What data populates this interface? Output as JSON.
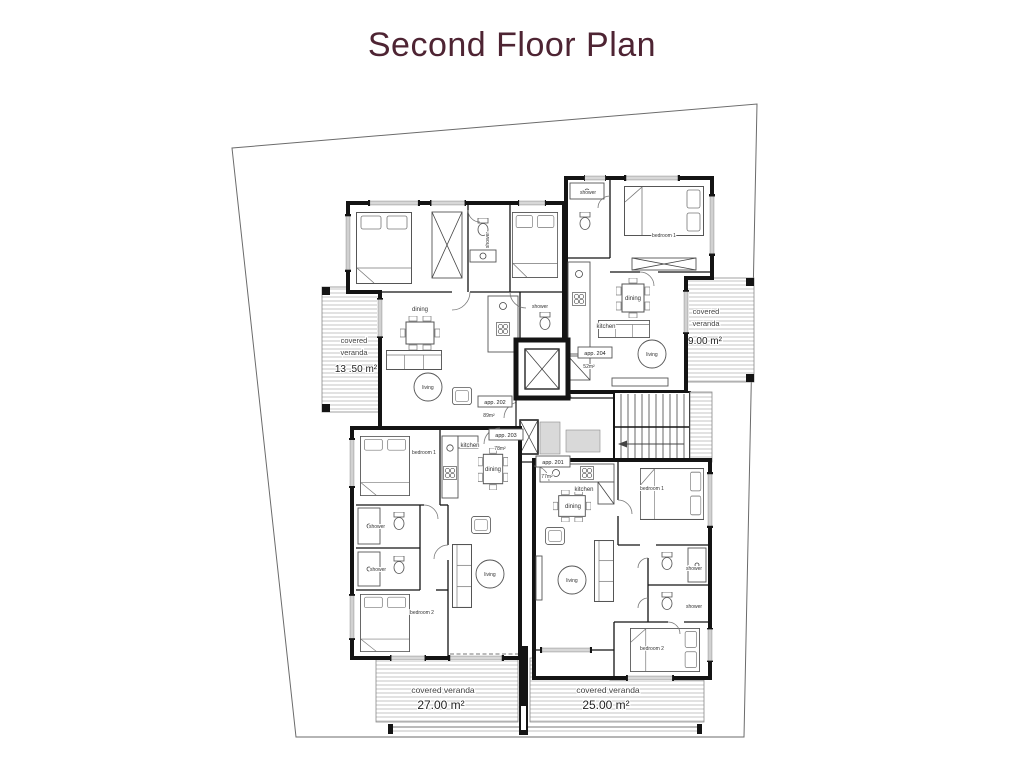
{
  "page": {
    "title": "Second Floor Plan"
  },
  "theme": {
    "title_color": "#4e2433",
    "wall_color": "#141414",
    "hatch_color": "#c4c4c4"
  },
  "verandas": {
    "left": {
      "word1": "covered",
      "word2": "veranda",
      "area": "13 .50 m²"
    },
    "right": {
      "word1": "covered",
      "word2": "veranda",
      "area": "9.00 m²"
    },
    "bottom_left": {
      "name": "covered veranda",
      "area": "27.00 m²"
    },
    "bottom_right": {
      "name": "covered veranda",
      "area": "25.00 m²"
    }
  },
  "apartments": {
    "a202": {
      "tag": "app. 202",
      "area": "89m²",
      "rooms": {
        "dining": "dining",
        "living": "living",
        "shower_a": "shower",
        "shower_b": "shower"
      }
    },
    "a204": {
      "tag": "app. 204",
      "area": "52m²",
      "rooms": {
        "shower": "shower",
        "bedroom1": "bedroom 1",
        "dining": "dining",
        "kitchen": "kitchen",
        "living": "living"
      }
    },
    "a203": {
      "tag": "app. 203",
      "area": "78m²",
      "rooms": {
        "bedroom1": "bedroom 1",
        "kitchen": "kitchen",
        "dining": "dining",
        "shower_a": "shower",
        "shower_b": "shower",
        "bedroom2": "bedroom 2",
        "living": "living"
      }
    },
    "a201": {
      "tag": "app. 201",
      "area": "77m²",
      "rooms": {
        "kitchen": "kitchen",
        "dining": "dining",
        "bedroom1": "bedroom 1",
        "shower_a": "shower",
        "shower_b": "shower",
        "living": "living",
        "bedroom2": "bedroom 2"
      }
    }
  }
}
